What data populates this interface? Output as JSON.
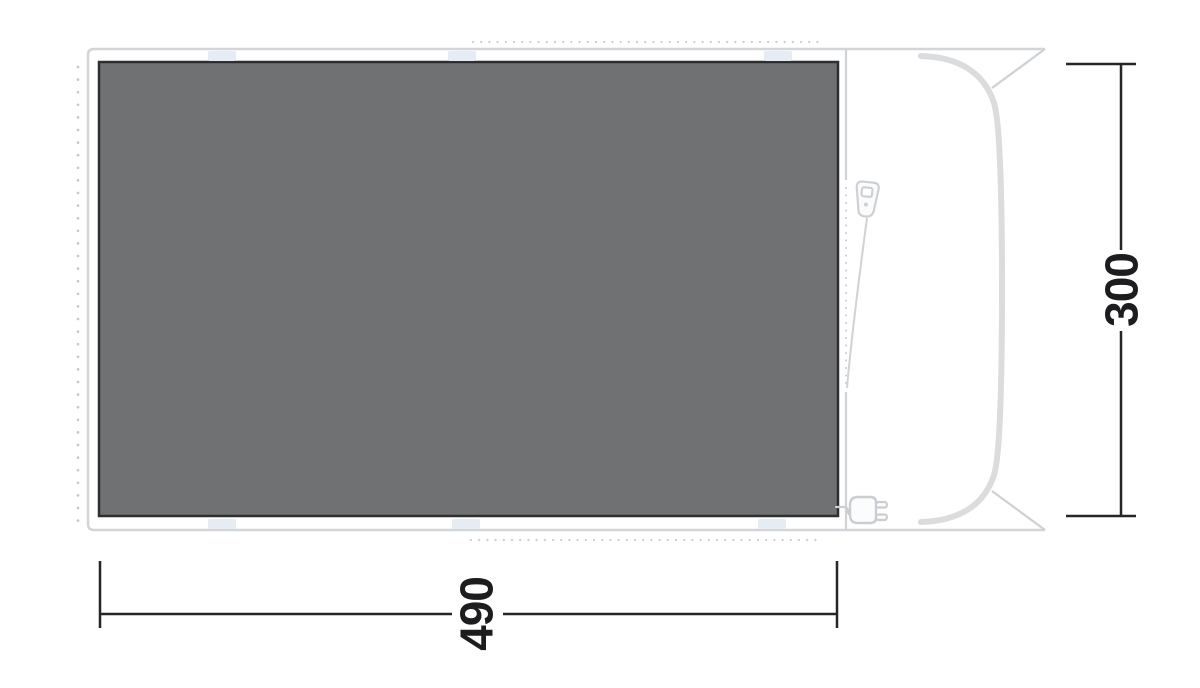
{
  "diagram": {
    "type": "tent-footprint-floorplan",
    "dimensions": {
      "width_label": "490",
      "height_label": "300"
    },
    "colors": {
      "background": "#ffffff",
      "groundsheet_fill": "#707173",
      "groundsheet_border": "#2e2f31",
      "tent_outline": "#d3d6d9",
      "detail_line": "#cdd1d5",
      "front_curve": "#dadcde",
      "dot_guide": "#c7cbcf",
      "attachment_tab": "#e6ecf4",
      "dimension_line": "#262626",
      "dimension_text": "#1d1d1f"
    },
    "icons": {
      "zipper_pull": "zipper-pull-icon",
      "power_plug": "power-plug-icon"
    }
  }
}
